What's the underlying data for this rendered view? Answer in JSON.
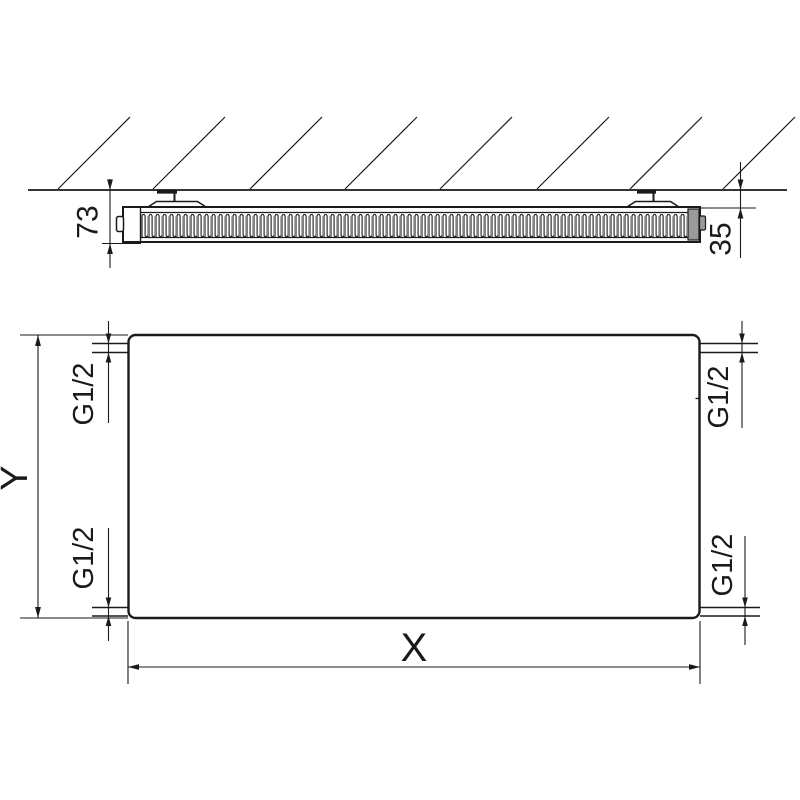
{
  "colors": {
    "line": "#1a1a1a",
    "end_cap": "#9a9a9a",
    "background": "#ffffff"
  },
  "side_view": {
    "depth_label": "73",
    "wall_gap_label": "35"
  },
  "front_view": {
    "height_label": "Y",
    "width_label": "X",
    "connection_top_left": "G1/2",
    "connection_top_right": "G1/2",
    "connection_bottom_left": "G1/2",
    "connection_bottom_right": "G1/2"
  }
}
